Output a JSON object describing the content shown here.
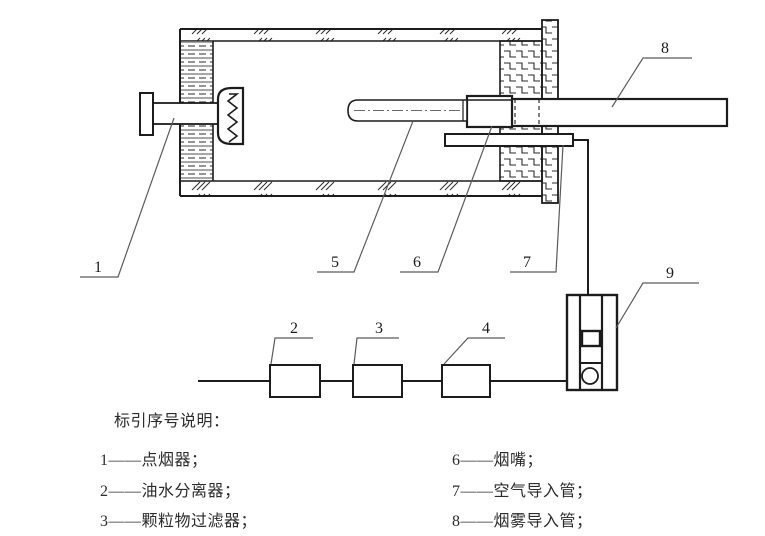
{
  "diagram": {
    "callouts": {
      "n1": "1",
      "n2": "2",
      "n3": "3",
      "n4": "4",
      "n5": "5",
      "n6": "6",
      "n7": "7",
      "n8": "8",
      "n9": "9"
    }
  },
  "legend": {
    "title": "标引序号说明：",
    "left": [
      "1——点烟器；",
      "2——油水分离器；",
      "3——颗粒物过滤器；"
    ],
    "right": [
      "6——烟嘴；",
      "7——空气导入管；",
      "8——烟雾导入管；"
    ]
  },
  "colors": {
    "line": "#1c1c1c",
    "leader": "#5a5a5a",
    "hatch": "#2a2a2a",
    "background": "#ffffff"
  }
}
